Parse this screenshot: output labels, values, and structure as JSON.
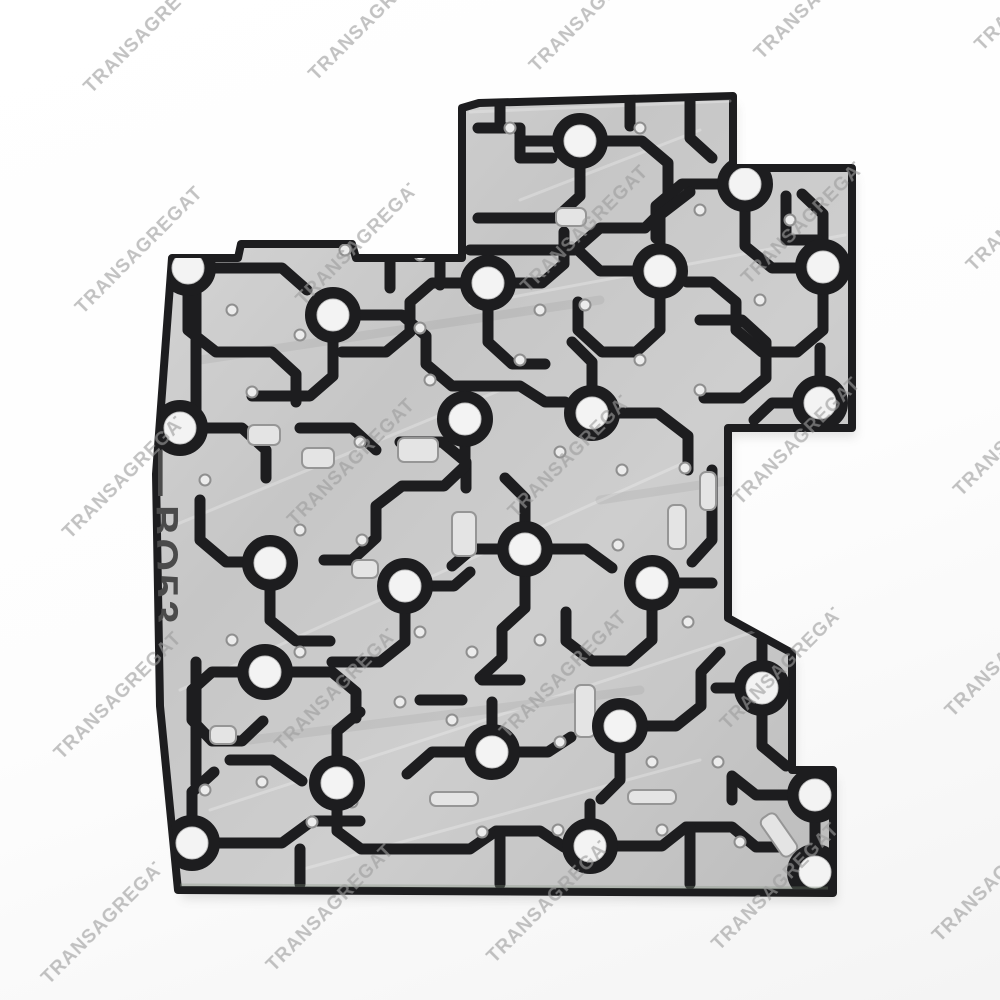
{
  "watermark": {
    "text": "TRANSAGREGAT",
    "color": "#9d9d9d"
  },
  "plate": {
    "marking": "BO53",
    "marking_prefix": "—",
    "metal_color": "#c8c8c8",
    "gasket_color": "#1d1d1f",
    "hole_color": "#f3f3f3",
    "stamp_color": "#4a4a4a"
  },
  "background_color": "#ffffff"
}
